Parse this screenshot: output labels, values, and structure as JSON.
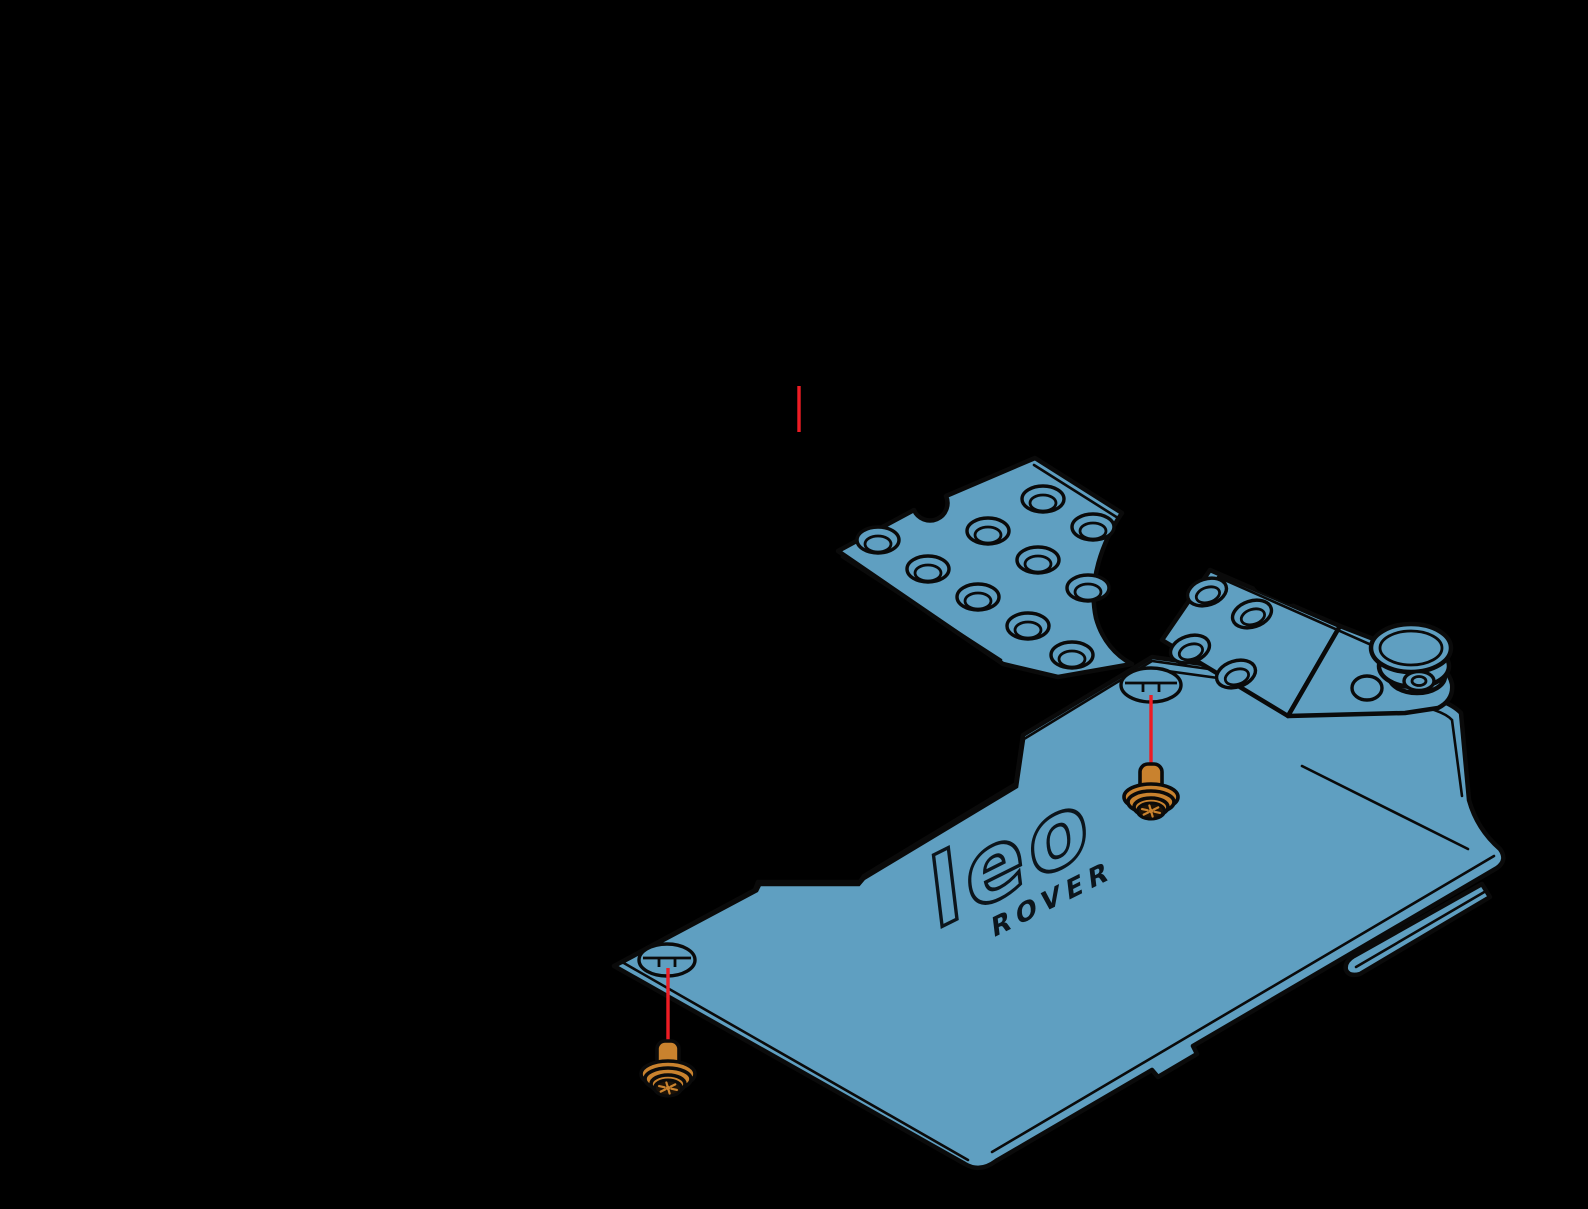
{
  "canvas": {
    "width": 1588,
    "height": 1209,
    "background": "#000000"
  },
  "colors": {
    "part_fill": "#5f9fc1",
    "outline": "#0a0a0a",
    "screw_fill": "#c9822e",
    "screw_dark": "#1d1206",
    "leader_red": "#ed1c24",
    "logo_ink": "#0c151c"
  },
  "logo": {
    "primary": "leo",
    "secondary": "ROVER"
  },
  "leader_lines": [
    {
      "x": 799,
      "y1": 386,
      "y2": 432
    },
    {
      "x": 1151,
      "y1": 695,
      "y2": 764
    },
    {
      "x": 668,
      "y1": 968,
      "y2": 1041
    }
  ],
  "screws": [
    {
      "x": 1151,
      "y": 764
    },
    {
      "x": 668,
      "y": 1041
    }
  ],
  "perforated_plate": {
    "countersunk_holes": [
      [
        878,
        540
      ],
      [
        928,
        569
      ],
      [
        978,
        597
      ],
      [
        1028,
        626
      ],
      [
        1072,
        655
      ],
      [
        988,
        531
      ],
      [
        1038,
        560
      ],
      [
        1088,
        588
      ],
      [
        1043,
        499
      ],
      [
        1093,
        527
      ]
    ]
  },
  "bracket": {
    "oval_holes": [
      [
        1207,
        592
      ],
      [
        1252,
        614
      ],
      [
        1190,
        649
      ],
      [
        1236,
        674
      ]
    ],
    "round_hole": {
      "cx": 1367,
      "cy": 688,
      "rx": 15,
      "ry": 12
    },
    "roller": {
      "cx": 1411,
      "cy": 648
    }
  },
  "cover_plate": {
    "screw_holes": [
      {
        "cx": 1151,
        "cy": 685,
        "rx": 30,
        "ry": 17
      },
      {
        "cx": 667,
        "cy": 960,
        "rx": 28,
        "ry": 16
      }
    ]
  }
}
